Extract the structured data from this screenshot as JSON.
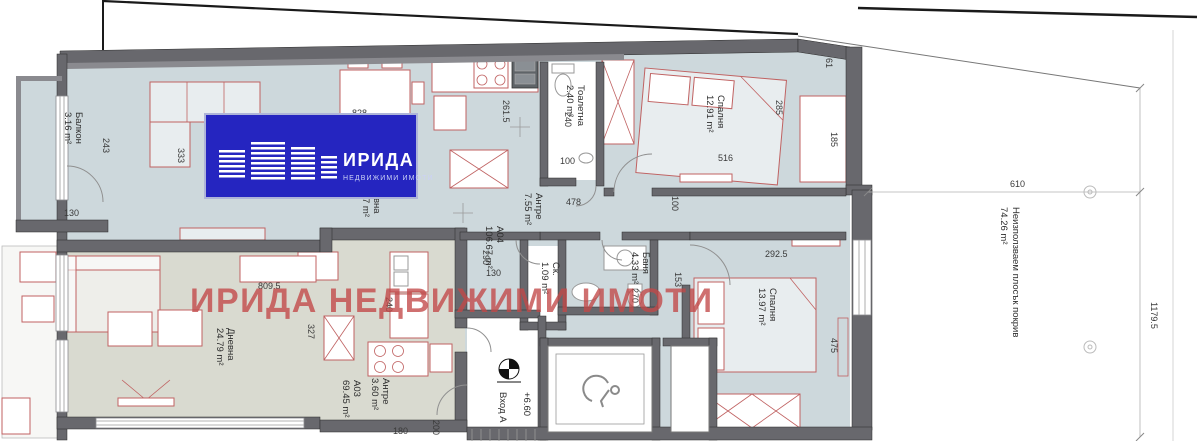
{
  "logo": {
    "title": "ИРИДА",
    "subtitle": "НЕДВИЖИМИ ИМОТИ",
    "bg_color": "#2525c0"
  },
  "watermark": {
    "text": "ИРИДА НЕДВИЖИМИ ИМОТИ",
    "color": "#c24848"
  },
  "entrance": {
    "label": "Вход А",
    "level": "+6.60"
  },
  "roof": {
    "label": "Неизползваем плосък покрив",
    "area": "74.26 m²"
  },
  "rooms": [
    {
      "name": "Балкон",
      "area": "3.16 m²"
    },
    {
      "name": "Тоалетна",
      "area": "2.40 m²"
    },
    {
      "name": "Спалня",
      "area": "12.91 m²"
    },
    {
      "name": "Антре",
      "area": "7.55 m²"
    },
    {
      "name": "Ск.",
      "area": "1.09 m²"
    },
    {
      "name": "Баня",
      "area": "4.33 m²"
    },
    {
      "name": "Спалня",
      "area": "13.97 m²"
    },
    {
      "name": "Дневна",
      "area": "24.79 m²"
    },
    {
      "name": "Антре",
      "area": "3.60 m²"
    },
    {
      "name": "А04",
      "area": "106.67 m²"
    },
    {
      "name": "А03",
      "area": "69.45 m²"
    },
    {
      "name": "вна",
      "area": "7 m²"
    }
  ],
  "dims": [
    "333",
    "243",
    "130",
    "261.5",
    "240",
    "100",
    "478",
    "516",
    "285",
    "61",
    "185",
    "100",
    "290",
    "130",
    "153",
    "270",
    "292.5",
    "475",
    "809.5",
    "327",
    "240",
    "180",
    "200",
    "610",
    "1179.5",
    "828"
  ],
  "colors": {
    "floor_a04": "#cdd8dc",
    "floor_a03": "#d9dad0",
    "walls": "#68686d",
    "furniture_outline": "#c06262"
  }
}
